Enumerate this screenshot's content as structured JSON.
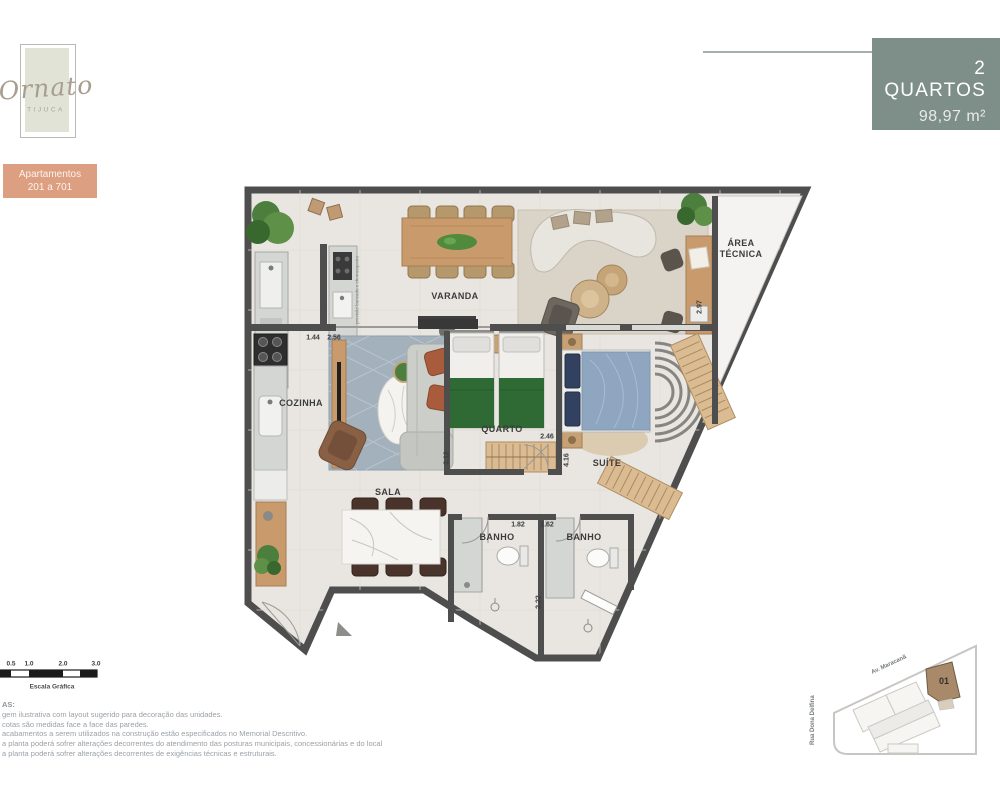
{
  "brand": {
    "logo_script": "Ornato",
    "logo_sub": "TIJUCA",
    "badge_line1": "Apartamentos",
    "badge_line2": "201 a 701"
  },
  "header": {
    "title": "2 QUARTOS",
    "area": "98,97 m²"
  },
  "plan": {
    "labels": {
      "varanda": "VARANDA",
      "area_tecnica_1": "ÁREA",
      "area_tecnica_2": "TÉCNICA",
      "cozinha": "COZINHA",
      "sala": "SALA",
      "quarto": "QUARTO",
      "suite": "SUÍTE",
      "banho1": "BANHO",
      "banho2": "BANHO"
    },
    "dimensions": {
      "d144": "1.44",
      "d256": "2.56",
      "d297": "2.97",
      "d312": "3.12",
      "d246": "2.46",
      "d416": "4.16",
      "d418": "4.18",
      "d182": "1.82",
      "d162": "1.62",
      "d222": "2.22"
    },
    "annotation": "previsão bancada e churrasqueira",
    "colors": {
      "wall": "#4E4E4E",
      "floor": "#E9E6E1",
      "wood": "#C99B6C",
      "green": "#4C7F3E",
      "rug_blue": "#A3B1BD",
      "suite_bed": "#8FA6C0",
      "header_bg": "#7E8E89",
      "badge_bg": "#DC9F82",
      "unit_brown": "#A8896A"
    }
  },
  "scale_bar": {
    "labels": [
      "0.5",
      "1.0",
      "2.0",
      "3.0"
    ],
    "caption": "Escala Gráfica"
  },
  "notes": {
    "heading_fragment": "AS:",
    "lines": [
      "gem ilustrativa com layout sugerido para decoração das unidades.",
      "cotas são medidas face a face das paredes.",
      "acabamentos a serem utilizados na construção estão especificados no Memorial Descritivo.",
      "a planta poderá sofrer alterações decorrentes do atendimento das posturas municipais, concessionárias e do local",
      "a planta poderá sofrer alterações decorrentes de exigências técnicas e estruturais."
    ]
  },
  "key_map": {
    "street_top": "Av. Maracanã",
    "street_left": "Rua Dona Delfina",
    "unit": "01"
  }
}
